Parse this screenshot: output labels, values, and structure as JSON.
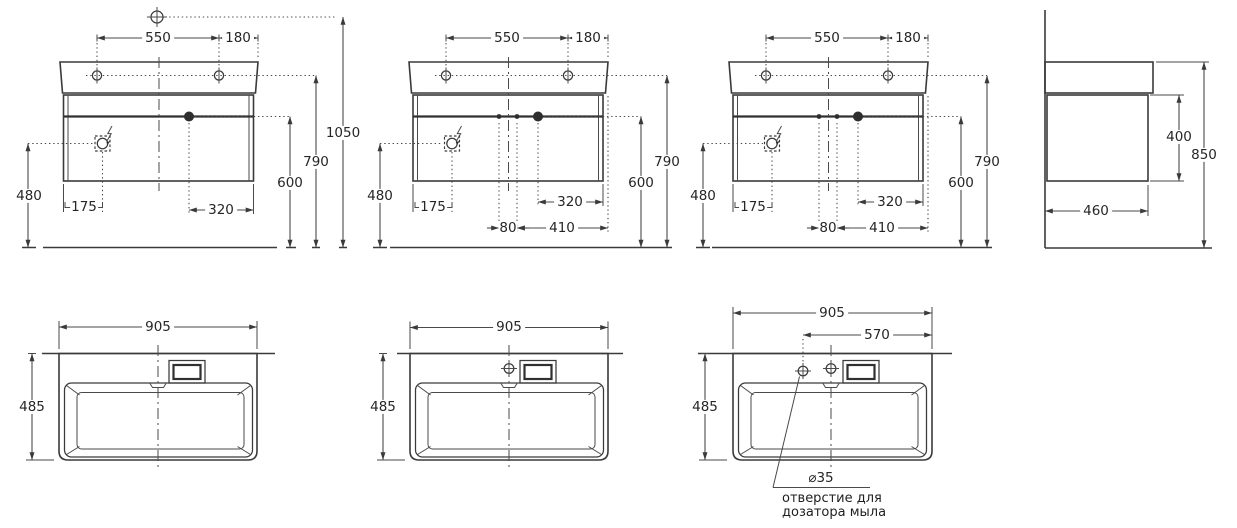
{
  "front_views": [
    {
      "d550": "550",
      "d180": "180",
      "d1050": "1050",
      "d790": "790",
      "d600": "600",
      "d480": "480",
      "d175": "175",
      "d320": "320"
    },
    {
      "d550": "550",
      "d180": "180",
      "d790": "790",
      "d600": "600",
      "d480": "480",
      "d175": "175",
      "d320": "320",
      "d80": "80",
      "d410": "410"
    },
    {
      "d550": "550",
      "d180": "180",
      "d790": "790",
      "d600": "600",
      "d480": "480",
      "d175": "175",
      "d320": "320",
      "d80": "80",
      "d410": "410"
    }
  ],
  "side_view": {
    "d400": "400",
    "d850": "850",
    "d460": "460"
  },
  "top_views": [
    {
      "d905": "905",
      "d485": "485"
    },
    {
      "d905": "905",
      "d485": "485"
    },
    {
      "d905": "905",
      "d570": "570",
      "d485": "485",
      "d_hole": "⌀35",
      "note1": "отверстие для",
      "note2": "дозатора мыла"
    }
  ],
  "colors": {
    "line": "#3a3a3a",
    "text": "#262626",
    "background": "#ffffff"
  }
}
